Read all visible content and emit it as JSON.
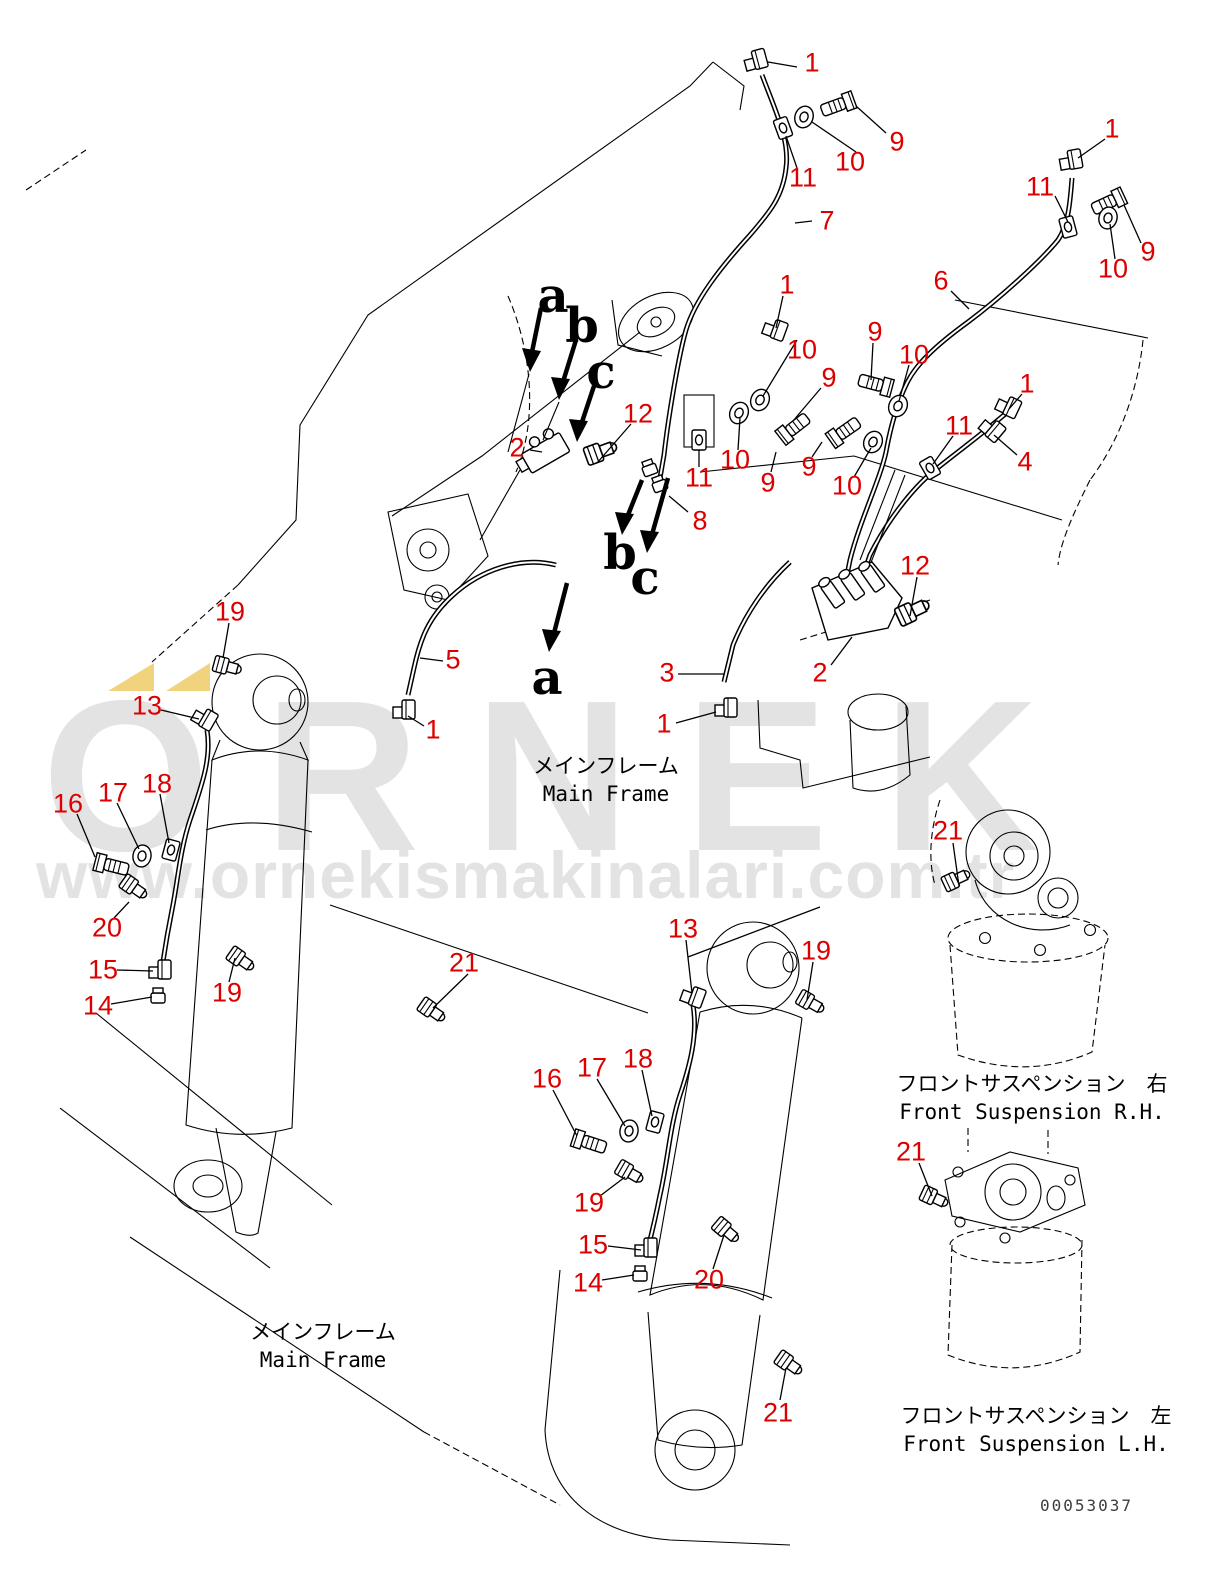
{
  "meta": {
    "background": "#ffffff",
    "line_color": "#000000",
    "callout_color": "#dd0000",
    "drawing_number": "00053037"
  },
  "watermark": {
    "brand_text": "ORNEK",
    "url_text": "www.ornekismakinalari.com.tr",
    "letter_color": "#e3e3e3",
    "accent_color": "#f1d37e"
  },
  "frame_labels": {
    "main_frame_upper": {
      "jp": "メインフレーム",
      "en": "Main Frame"
    },
    "main_frame_lower": {
      "jp": "メインフレーム",
      "en": "Main Frame"
    },
    "suspension_rh": {
      "jp": "フロントサスペンション　右",
      "en": "Front Suspension R.H."
    },
    "suspension_lh": {
      "jp": "フロントサスペンション　左",
      "en": "Front Suspension L.H."
    }
  },
  "callouts": [
    {
      "n": "1",
      "x": 812,
      "y": 63
    },
    {
      "n": "9",
      "x": 897,
      "y": 142
    },
    {
      "n": "10",
      "x": 850,
      "y": 162
    },
    {
      "n": "11",
      "x": 803,
      "y": 178
    },
    {
      "n": "7",
      "x": 827,
      "y": 221
    },
    {
      "n": "1",
      "x": 1112,
      "y": 129
    },
    {
      "n": "11",
      "x": 1040,
      "y": 187
    },
    {
      "n": "9",
      "x": 1148,
      "y": 252
    },
    {
      "n": "10",
      "x": 1113,
      "y": 269
    },
    {
      "n": "6",
      "x": 941,
      "y": 281
    },
    {
      "n": "1",
      "x": 787,
      "y": 285
    },
    {
      "n": "10",
      "x": 802,
      "y": 350
    },
    {
      "n": "9",
      "x": 875,
      "y": 332
    },
    {
      "n": "10",
      "x": 914,
      "y": 355
    },
    {
      "n": "9",
      "x": 829,
      "y": 378
    },
    {
      "n": "2",
      "x": 517,
      "y": 448
    },
    {
      "n": "12",
      "x": 638,
      "y": 414
    },
    {
      "n": "11",
      "x": 699,
      "y": 478
    },
    {
      "n": "10",
      "x": 735,
      "y": 460
    },
    {
      "n": "9",
      "x": 768,
      "y": 483
    },
    {
      "n": "9",
      "x": 809,
      "y": 467
    },
    {
      "n": "10",
      "x": 847,
      "y": 486
    },
    {
      "n": "8",
      "x": 700,
      "y": 521
    },
    {
      "n": "1",
      "x": 1027,
      "y": 384
    },
    {
      "n": "11",
      "x": 959,
      "y": 426
    },
    {
      "n": "4",
      "x": 1025,
      "y": 462
    },
    {
      "n": "12",
      "x": 915,
      "y": 566
    },
    {
      "n": "5",
      "x": 453,
      "y": 660
    },
    {
      "n": "3",
      "x": 667,
      "y": 673
    },
    {
      "n": "2",
      "x": 820,
      "y": 673
    },
    {
      "n": "1",
      "x": 433,
      "y": 730
    },
    {
      "n": "1",
      "x": 664,
      "y": 724
    },
    {
      "n": "19",
      "x": 230,
      "y": 612
    },
    {
      "n": "13",
      "x": 147,
      "y": 706
    },
    {
      "n": "16",
      "x": 68,
      "y": 804
    },
    {
      "n": "17",
      "x": 113,
      "y": 793
    },
    {
      "n": "18",
      "x": 157,
      "y": 784
    },
    {
      "n": "20",
      "x": 107,
      "y": 928
    },
    {
      "n": "15",
      "x": 103,
      "y": 970
    },
    {
      "n": "14",
      "x": 98,
      "y": 1006
    },
    {
      "n": "19",
      "x": 227,
      "y": 993
    },
    {
      "n": "21",
      "x": 464,
      "y": 963
    },
    {
      "n": "13",
      "x": 683,
      "y": 929
    },
    {
      "n": "19",
      "x": 816,
      "y": 951
    },
    {
      "n": "16",
      "x": 547,
      "y": 1079
    },
    {
      "n": "17",
      "x": 592,
      "y": 1068
    },
    {
      "n": "18",
      "x": 638,
      "y": 1059
    },
    {
      "n": "19",
      "x": 589,
      "y": 1203
    },
    {
      "n": "15",
      "x": 593,
      "y": 1245
    },
    {
      "n": "14",
      "x": 588,
      "y": 1283
    },
    {
      "n": "20",
      "x": 709,
      "y": 1280
    },
    {
      "n": "21",
      "x": 778,
      "y": 1413
    },
    {
      "n": "21",
      "x": 948,
      "y": 831
    },
    {
      "n": "21",
      "x": 911,
      "y": 1152
    }
  ],
  "view_letters": [
    {
      "n": "a",
      "x": 553,
      "y": 296
    },
    {
      "n": "b",
      "x": 582,
      "y": 326
    },
    {
      "n": "c",
      "x": 601,
      "y": 372
    },
    {
      "n": "b",
      "x": 620,
      "y": 553
    },
    {
      "n": "c",
      "x": 645,
      "y": 578
    },
    {
      "n": "a",
      "x": 547,
      "y": 678
    }
  ]
}
